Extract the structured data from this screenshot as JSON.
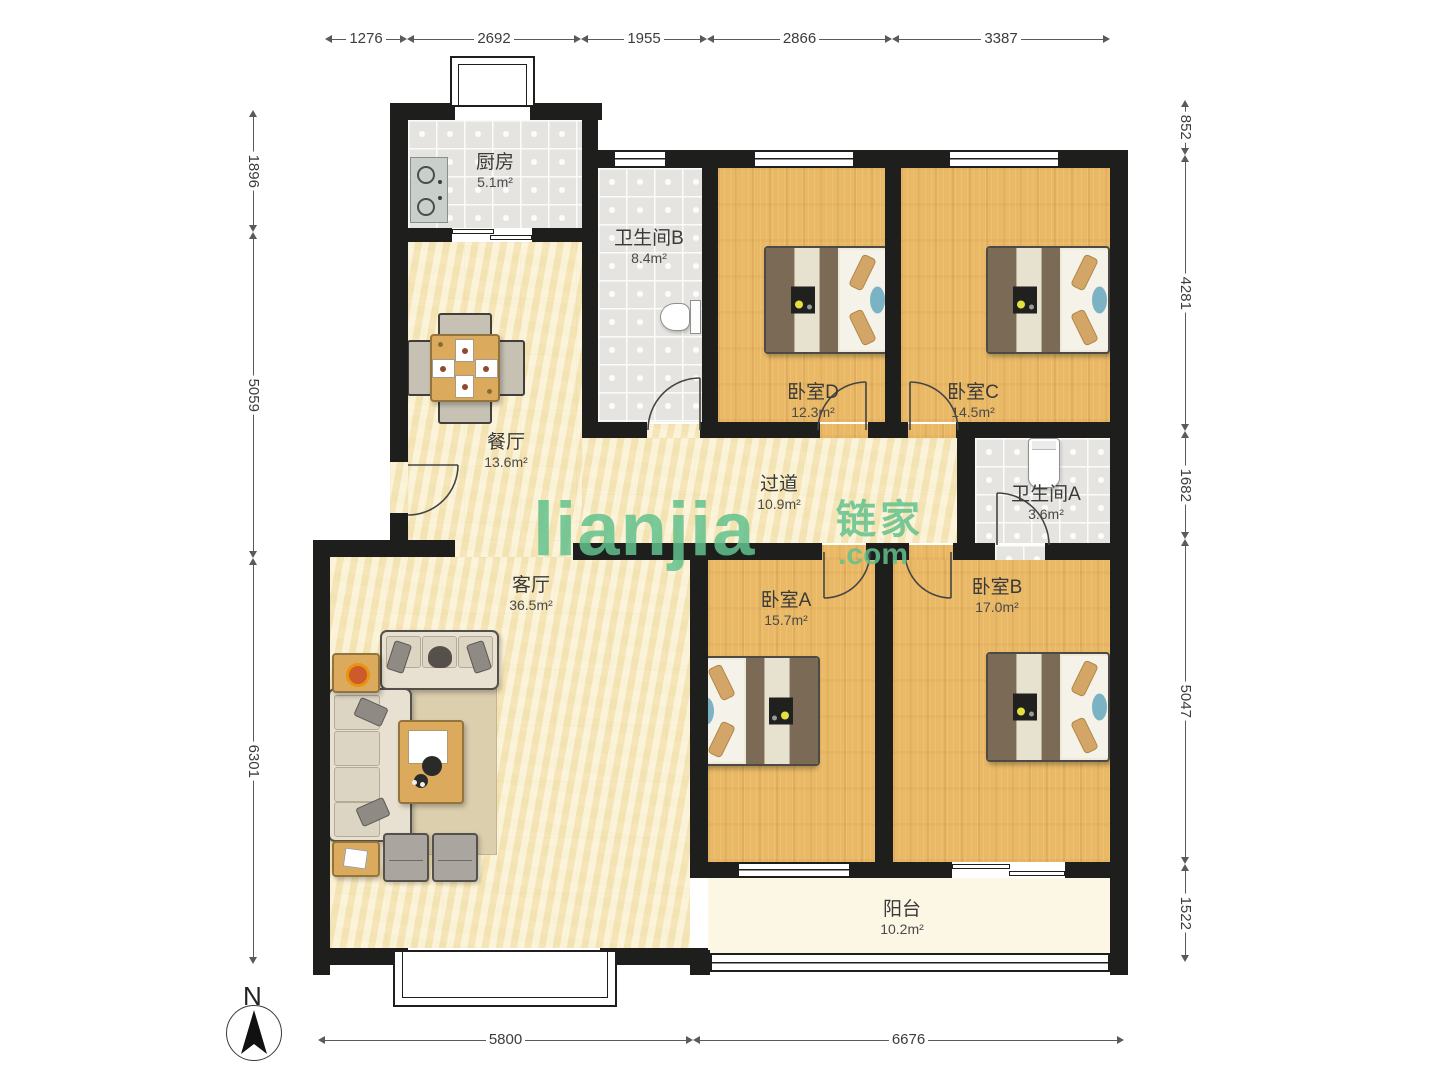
{
  "watermark": {
    "brand": "lianjia",
    "cn": "链家",
    "tld": ".com",
    "color": "#62c18d"
  },
  "compass": {
    "label": "N"
  },
  "colors": {
    "wall": "#1e1e1c",
    "wood_floor": "#eab966",
    "pale_floor": "#f6e7bb",
    "tile_floor": "#e5e4e0",
    "balcony_floor": "#fbf7e4"
  },
  "rooms": [
    {
      "name": "厨房",
      "area": "5.1m²"
    },
    {
      "name": "卫生间B",
      "area": "8.4m²"
    },
    {
      "name": "卧室D",
      "area": "12.3m²"
    },
    {
      "name": "卧室C",
      "area": "14.5m²"
    },
    {
      "name": "餐厅",
      "area": "13.6m²"
    },
    {
      "name": "过道",
      "area": "10.9m²"
    },
    {
      "name": "卫生间A",
      "area": "3.6m²"
    },
    {
      "name": "客厅",
      "area": "36.5m²"
    },
    {
      "name": "卧室A",
      "area": "15.7m²"
    },
    {
      "name": "卧室B",
      "area": "17.0m²"
    },
    {
      "name": "阳台",
      "area": "10.2m²"
    }
  ],
  "dims": {
    "top": [
      "1276",
      "2692",
      "1955",
      "2866",
      "3387"
    ],
    "left": [
      "1896",
      "5059",
      "6301"
    ],
    "right": [
      "852",
      "4281",
      "1682",
      "5047",
      "1522"
    ],
    "bottom": [
      "5800",
      "6676"
    ]
  }
}
